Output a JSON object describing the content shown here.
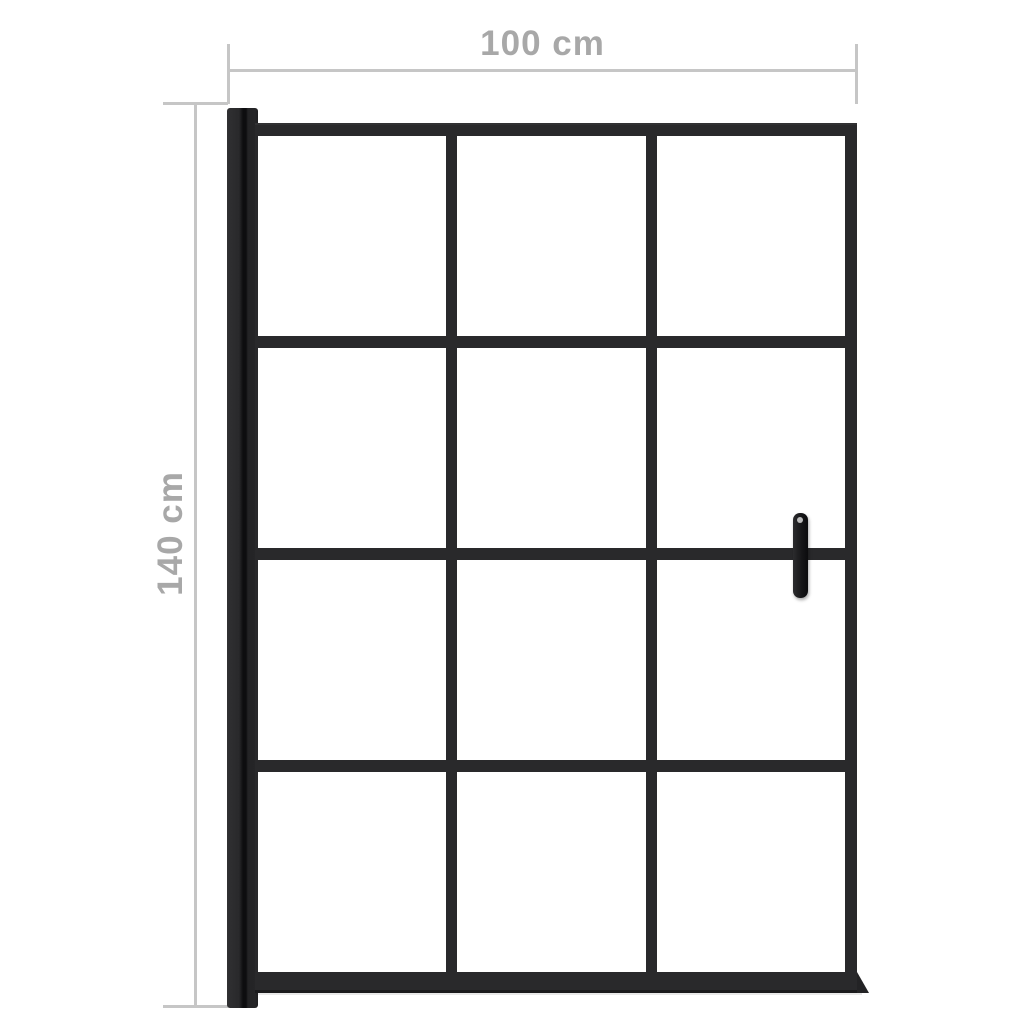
{
  "diagram": {
    "type": "product-dimension-diagram",
    "product": "framed shower door with 3x4 glass grid and wall profile and handle",
    "dimensions": {
      "width_label": "100 cm",
      "height_label": "140 cm"
    },
    "door": {
      "grid": {
        "columns": 3,
        "rows": 4
      },
      "handle_side": "right",
      "hinge_side": "left"
    },
    "colors": {
      "frame": "#29292b",
      "dimension_line": "#c6c6c6",
      "dimension_text": "#a8a8a8",
      "background": "#ffffff",
      "glass": "#ffffff"
    }
  }
}
